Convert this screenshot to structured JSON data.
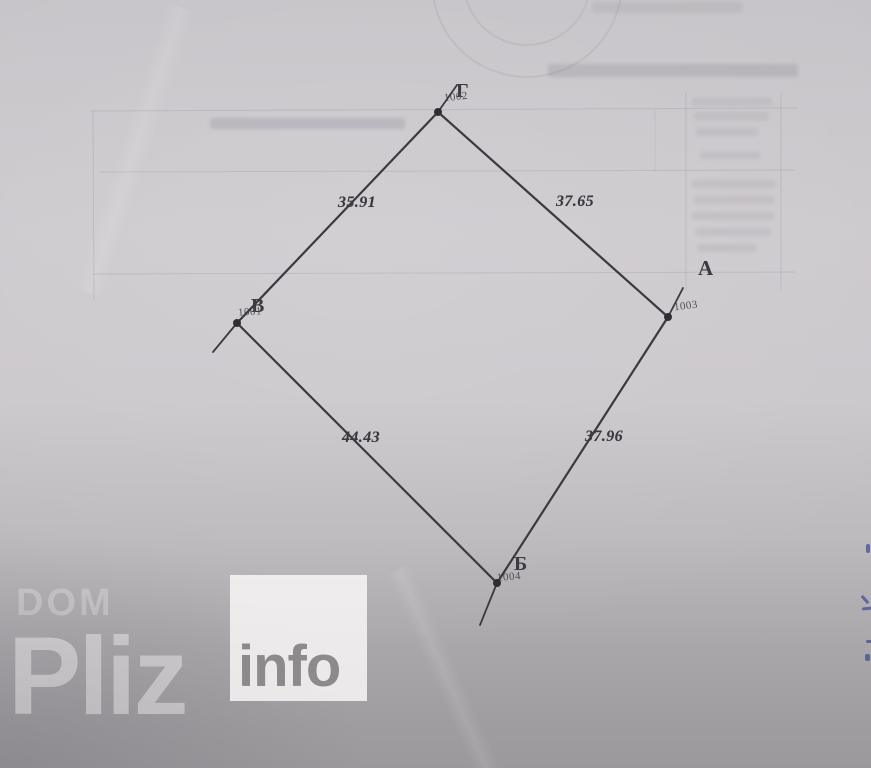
{
  "diagram": {
    "description": "Land parcel boundary sketch (cadastral plan) on scanned paper",
    "vertices": [
      {
        "letter": "Г",
        "point_number": "1002",
        "position": "top"
      },
      {
        "letter": "А",
        "point_number": "1003",
        "position": "right"
      },
      {
        "letter": "Б",
        "point_number": "1004",
        "position": "bottom"
      },
      {
        "letter": "В",
        "point_number": "1001",
        "position": "left"
      }
    ],
    "side_lengths": [
      {
        "from": "В",
        "to": "Г",
        "value": "35.91"
      },
      {
        "from": "Г",
        "to": "А",
        "value": "37.65"
      },
      {
        "from": "А",
        "to": "Б",
        "value": "37.96"
      },
      {
        "from": "Б",
        "to": "В",
        "value": "44.43"
      }
    ],
    "ink_color": "#3b3a40"
  },
  "watermark": {
    "line1": "DOM",
    "line2": "Pliz",
    "badge": "info"
  }
}
